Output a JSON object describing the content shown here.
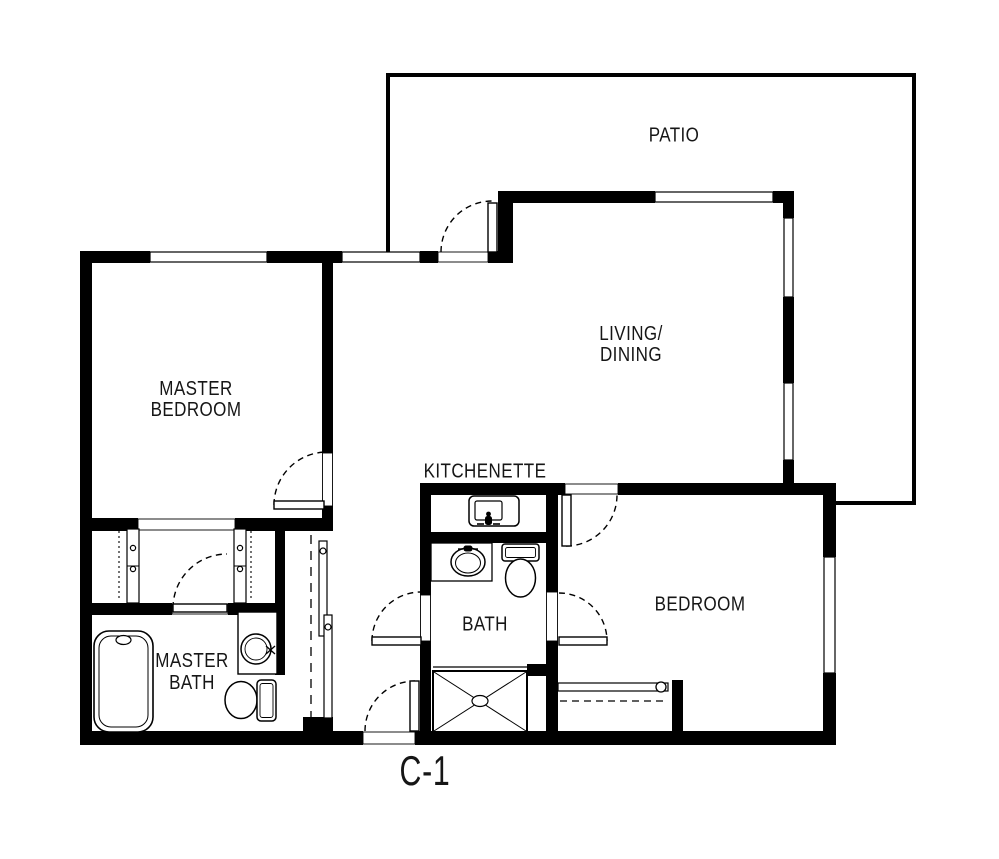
{
  "plan": {
    "code": "C-1"
  },
  "rooms": {
    "patio": {
      "label": "PATIO"
    },
    "living_dining": {
      "lines": [
        "LIVING/",
        "DINING"
      ]
    },
    "master_bedroom": {
      "lines": [
        "MASTER",
        "BEDROOM"
      ]
    },
    "kitchenette": {
      "label": "KITCHENETTE"
    },
    "bath": {
      "label": "BATH"
    },
    "bedroom": {
      "label": "BEDROOM"
    },
    "master_bath": {
      "lines": [
        "MASTER",
        "BATH"
      ]
    }
  },
  "colors": {
    "wall": "#000000",
    "background": "#ffffff",
    "line": "#000000"
  }
}
